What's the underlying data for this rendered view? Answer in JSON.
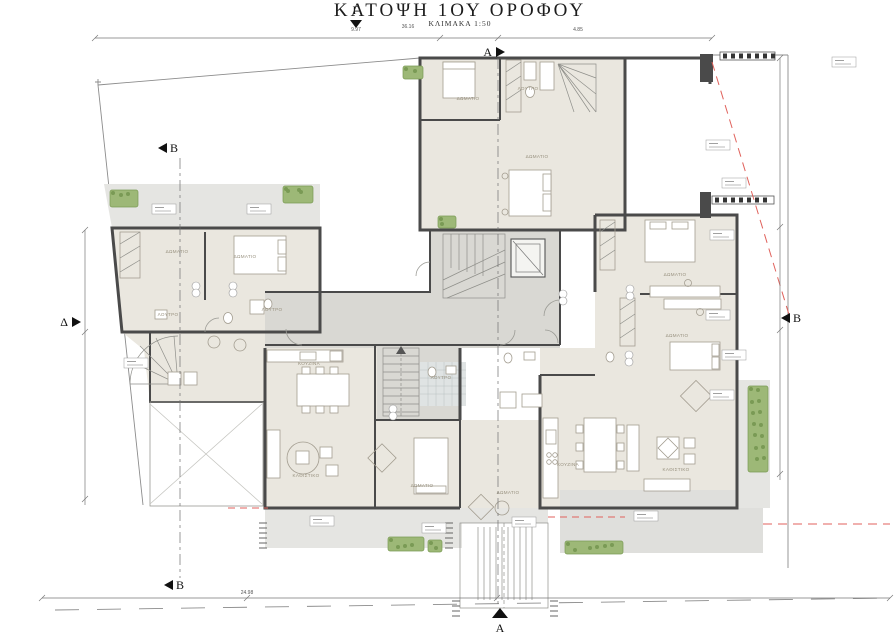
{
  "title": {
    "main": "ΚΑΤΟΨΗ 1ΟΥ ΟΡΟΦΟΥ",
    "scale": "ΚΛΙΜΑΚΑ 1:50"
  },
  "colors": {
    "room_fill": "#eae7df",
    "common_fill": "#d9d8d3",
    "balcony_fill": "#e5e5e2",
    "terrace_fill": "#dfdfdc",
    "bath_tile": "#dfe3e3",
    "wall": "#4a4a4a",
    "plant_green": "#9db877",
    "plant_dark": "#7a9a55",
    "red_dash": "#e0625c"
  },
  "section_markers": [
    {
      "label": "Γ",
      "x": 356,
      "y": 14,
      "dir": "down"
    },
    {
      "label": "A",
      "x": 496,
      "y": 47,
      "dir": "right"
    },
    {
      "label": "Δ",
      "x": 72,
      "y": 317,
      "dir": "right"
    },
    {
      "label": "B",
      "x": 790,
      "y": 313,
      "dir": "left"
    },
    {
      "label": "B",
      "x": 167,
      "y": 143,
      "dir": "left"
    },
    {
      "label": "B",
      "x": 173,
      "y": 580,
      "dir": "left"
    },
    {
      "label": "A",
      "x": 500,
      "y": 616,
      "dir": "up"
    }
  ],
  "room_labels": [
    {
      "t": "ΔΩΜΑΤΙΟ",
      "x": 468,
      "y": 100
    },
    {
      "t": "ΛΟΥΤΡΟ",
      "x": 528,
      "y": 90
    },
    {
      "t": "ΔΩΜΑΤΙΟ",
      "x": 537,
      "y": 158
    },
    {
      "t": "ΔΩΜΑΤΙΟ",
      "x": 177,
      "y": 253
    },
    {
      "t": "ΔΩΜΑΤΙΟ",
      "x": 245,
      "y": 258
    },
    {
      "t": "ΛΟΥΤΡΟ",
      "x": 168,
      "y": 316
    },
    {
      "t": "ΛΟΥΤΡΟ",
      "x": 272,
      "y": 311
    },
    {
      "t": "ΛΟΥΤΡΟ",
      "x": 441,
      "y": 379
    },
    {
      "t": "ΚΟΥΖΙΝΑ",
      "x": 309,
      "y": 365
    },
    {
      "t": "ΚΑΘΙΣΤΙΚΟ",
      "x": 306,
      "y": 477
    },
    {
      "t": "ΔΩΜΑΤΙΟ",
      "x": 422,
      "y": 487
    },
    {
      "t": "ΔΩΜΑΤΙΟ",
      "x": 508,
      "y": 494
    },
    {
      "t": "ΚΟΥΖΙΝΑ",
      "x": 568,
      "y": 466
    },
    {
      "t": "ΚΑΘΙΣΤΙΚΟ",
      "x": 676,
      "y": 471
    },
    {
      "t": "ΔΩΜΑΤΙΟ",
      "x": 675,
      "y": 276
    },
    {
      "t": "ΔΩΜΑΤΙΟ",
      "x": 677,
      "y": 337
    }
  ],
  "dim_labels": [
    {
      "t": "9.97",
      "x": 356,
      "y": 31
    },
    {
      "t": "36.16",
      "x": 408,
      "y": 28
    },
    {
      "t": "4.85",
      "x": 578,
      "y": 31
    },
    {
      "t": "24.98",
      "x": 247,
      "y": 594
    }
  ]
}
